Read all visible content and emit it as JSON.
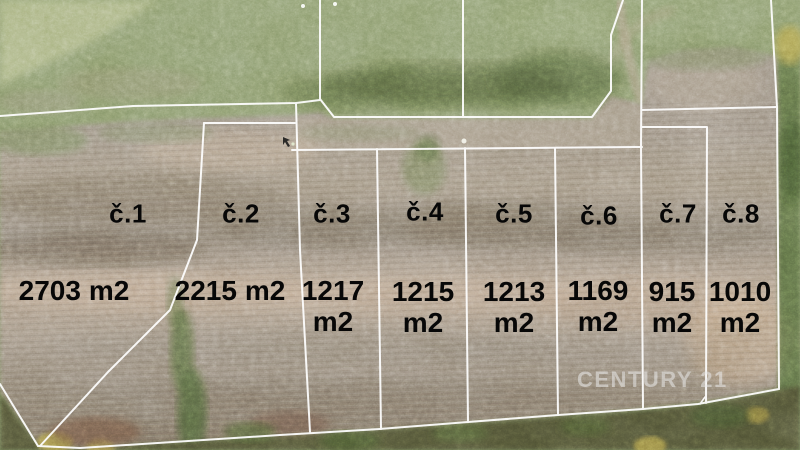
{
  "plots": [
    {
      "number": "č.1",
      "area_value": "2703",
      "area_unit": "m2"
    },
    {
      "number": "č.2",
      "area_value": "2215",
      "area_unit": "m2"
    },
    {
      "number": "č.3",
      "area_value": "1217",
      "area_unit": "m2"
    },
    {
      "number": "č.4",
      "area_value": "1215",
      "area_unit": "m2"
    },
    {
      "number": "č.5",
      "area_value": "1213",
      "area_unit": "m2"
    },
    {
      "number": "č.6",
      "area_value": "1169",
      "area_unit": "m2"
    },
    {
      "number": "č.7",
      "area_value": "915",
      "area_unit": "m2"
    },
    {
      "number": "č.8",
      "area_value": "1010",
      "area_unit": "m2"
    }
  ],
  "watermark": {
    "text": "CENTURY 21"
  },
  "colors": {
    "boundary_line": "#ffffff",
    "label_text": "#070707",
    "watermark_text": "#e9e9e9"
  }
}
